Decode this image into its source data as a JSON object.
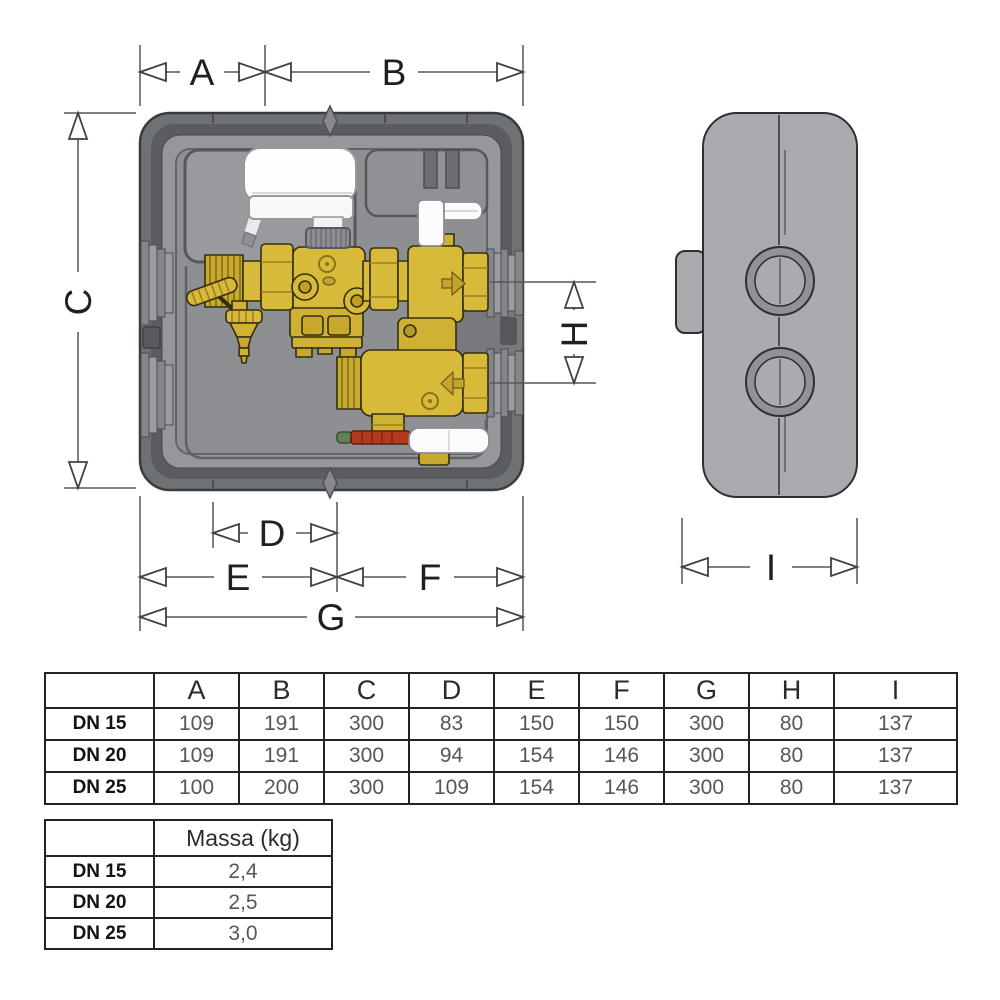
{
  "diagram": {
    "dimension_labels": {
      "a": "A",
      "b": "B",
      "c": "C",
      "d": "D",
      "e": "E",
      "f": "F",
      "g": "G",
      "h": "H",
      "i": "I"
    },
    "flow_arrows": {
      "upper": "right",
      "lower": "left"
    },
    "colors": {
      "box_frame": "#6f7275",
      "box_inner_band": "#5a5c5f",
      "box_panel": "#96979b",
      "box_recess": "#8e8f93",
      "side_box": "#aaabaf",
      "brass": "#d8ba3a",
      "brass_dark": "#c8a92e",
      "actuator_white": "#fefefe",
      "ring_nut_grey": "#8c8e91",
      "thermometer_red": "#b13a1f",
      "clip_green": "#64805a",
      "dimension_line": "#4a4c4e"
    }
  },
  "dimension_table": {
    "columns": [
      "",
      "A",
      "B",
      "C",
      "D",
      "E",
      "F",
      "G",
      "H",
      "I"
    ],
    "rows": [
      {
        "label": "DN 15",
        "values": [
          "109",
          "191",
          "300",
          "83",
          "150",
          "150",
          "300",
          "80",
          "137"
        ]
      },
      {
        "label": "DN 20",
        "values": [
          "109",
          "191",
          "300",
          "94",
          "154",
          "146",
          "300",
          "80",
          "137"
        ]
      },
      {
        "label": "DN 25",
        "values": [
          "100",
          "200",
          "300",
          "109",
          "154",
          "146",
          "300",
          "80",
          "137"
        ]
      }
    ]
  },
  "mass_table": {
    "corner": "",
    "header": "Massa (kg)",
    "rows": [
      {
        "label": "DN 15",
        "value": "2,4"
      },
      {
        "label": "DN 20",
        "value": "2,5"
      },
      {
        "label": "DN 25",
        "value": "3,0"
      }
    ]
  }
}
